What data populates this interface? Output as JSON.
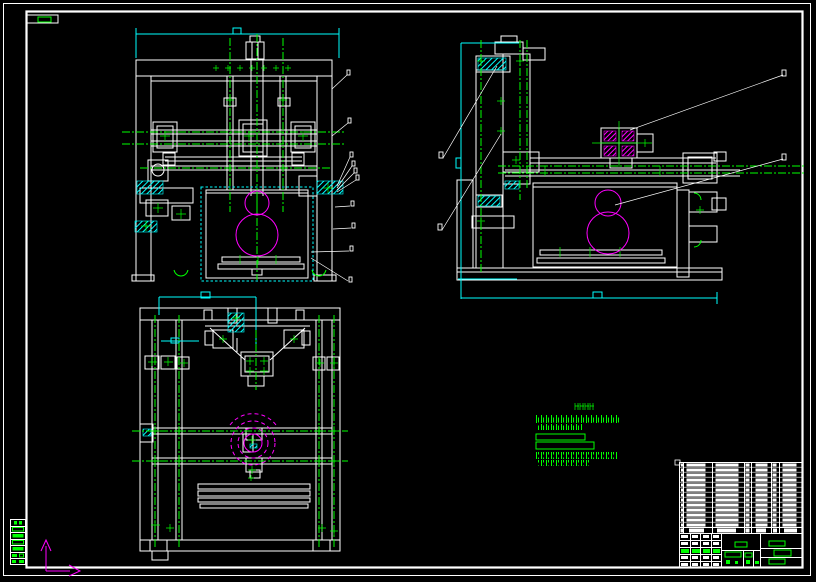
{
  "window": {
    "width": 816,
    "height": 582,
    "background": "#000000"
  },
  "palette": {
    "geometry": "#ffffff",
    "centerline": "#00ff00",
    "dimension": "#00ffff",
    "gear": "#ff00ff",
    "annotation": "#00ff00",
    "leader": "#ffffff",
    "axis": "#ff00ff",
    "border": "#ffffff",
    "title_accent": "#00ff00"
  },
  "sheet": {
    "border_style": "double-frame",
    "corner_marker": {
      "x": 38,
      "y": 17,
      "color": "#00ff00"
    },
    "margin_table_rows": 7
  },
  "views": {
    "front": {
      "name": "front-view",
      "gears": [
        {
          "cx": 257,
          "cy": 203,
          "r": 12
        },
        {
          "cx": 257,
          "cy": 235,
          "r": 21
        }
      ],
      "dimension_boxes": 1,
      "leader_count": 9
    },
    "side": {
      "name": "side-view",
      "gears": [
        {
          "cx": 608,
          "cy": 203,
          "r": 13
        },
        {
          "cx": 608,
          "cy": 233,
          "r": 21
        }
      ],
      "dimension_boxes": 2,
      "leader_count": 4
    },
    "plan": {
      "name": "plan-view",
      "gear_circles": [
        {
          "cx": 253,
          "cy": 443,
          "r": 9
        },
        {
          "cx": 253,
          "cy": 443,
          "r": 15
        },
        {
          "cx": 253,
          "cy": 443,
          "r": 22
        },
        {
          "cx": 253,
          "cy": 443,
          "r": 29
        }
      ],
      "dimension_boxes": 2
    }
  },
  "notes": {
    "heading_glyphs": 4,
    "text_lines": 6,
    "boxed_lines": 2,
    "color": "#00ff00"
  },
  "title_block": {
    "bom_rows": 13,
    "bom_columns": 7,
    "signature_rows": 5,
    "signature_columns": 4,
    "middle_fields": 2,
    "right_rows": 3
  },
  "ucs": {
    "arrows": [
      "up",
      "right"
    ],
    "color": "#ff00ff"
  }
}
